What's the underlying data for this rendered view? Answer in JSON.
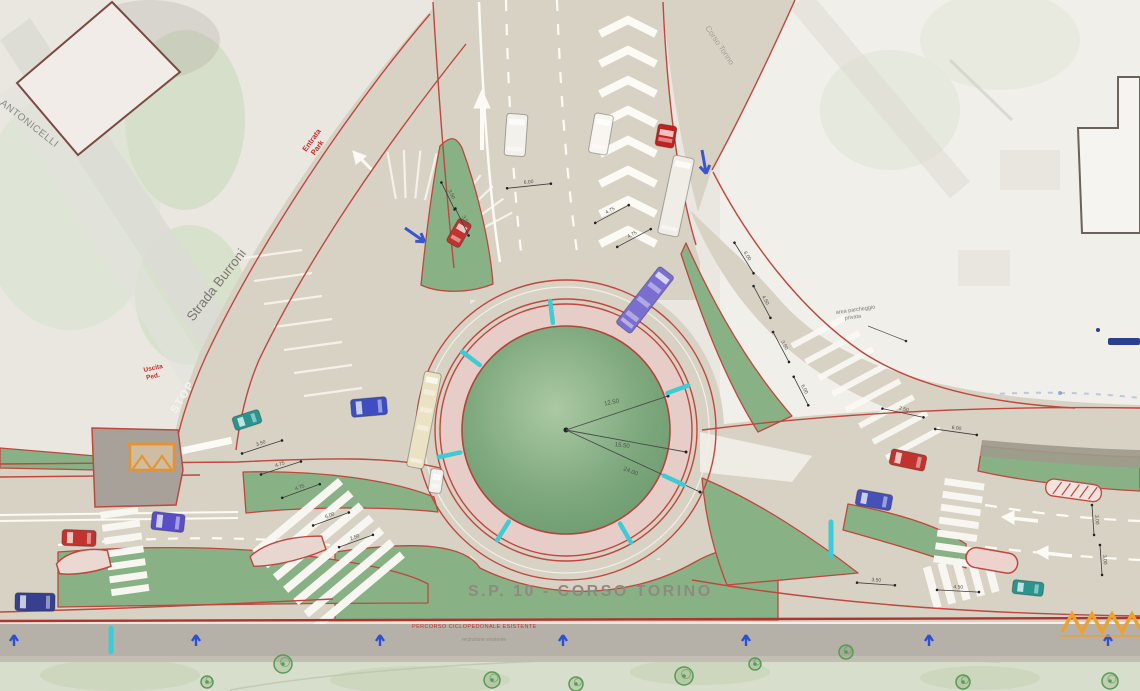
{
  "map": {
    "road_names": {
      "main": "S.P. 10 - CORSO TORINO",
      "northwest": "Strada Burroni",
      "west": "VIA ANTONICELLI",
      "northeast": "Corso Torino"
    },
    "road_markings": {
      "stop": "STOP"
    },
    "red_annotations": {
      "park_entrance": [
        "Entrata",
        "Park"
      ],
      "ped_exit": [
        "Uscita",
        "Ped."
      ],
      "cycle_path_note": "PERCORSO CICLOPEDONALE ESISTENTE"
    },
    "notes": {
      "private_parking": [
        "area parcheggio",
        "privata"
      ],
      "fence": "recinzione esistente"
    },
    "roundabout_dimensions": [
      "12.50",
      "15.50",
      "24.00"
    ],
    "dimension_labels": [
      "3.50",
      "4.75",
      "4.75",
      "6.00",
      "2.50",
      "6.00",
      "4.75",
      "4.75",
      "3.50",
      "3.50",
      "6.00",
      "4.50",
      "3.50",
      "6.00",
      "2.50",
      "6.00",
      "3.50",
      "4.50",
      "3.00",
      "3.00"
    ],
    "legend_colors": {
      "asphalt": "#d8d2c4",
      "green_island": "#7ea87d",
      "apron": "#e7cdc8",
      "curb": "#c0463e",
      "survey_cyan": "#3fcbd4",
      "survey_blue": "#2b4fd7",
      "shelter_orange": "#e8922e"
    },
    "vehicles": [
      {
        "kind": "car",
        "color": "#c0332e"
      },
      {
        "kind": "van",
        "color": "#f2f1ec"
      },
      {
        "kind": "truck",
        "color": "#f7f6f1"
      },
      {
        "kind": "truck-cab",
        "color": "#c4201d"
      },
      {
        "kind": "trailer",
        "color": "#efede6"
      },
      {
        "kind": "bus",
        "color": "#7a6ed0"
      },
      {
        "kind": "bus",
        "color": "#eae2c2"
      },
      {
        "kind": "car",
        "color": "#f2f0ea"
      },
      {
        "kind": "van",
        "color": "#3c4ec2"
      },
      {
        "kind": "car",
        "color": "#2a948e"
      },
      {
        "kind": "car",
        "color": "#c0332e"
      },
      {
        "kind": "van",
        "color": "#5a4ec8"
      },
      {
        "kind": "van",
        "color": "#35408f"
      },
      {
        "kind": "car",
        "color": "#c0332e"
      },
      {
        "kind": "car",
        "color": "#4550b8"
      },
      {
        "kind": "car",
        "color": "#2a948e"
      }
    ]
  }
}
